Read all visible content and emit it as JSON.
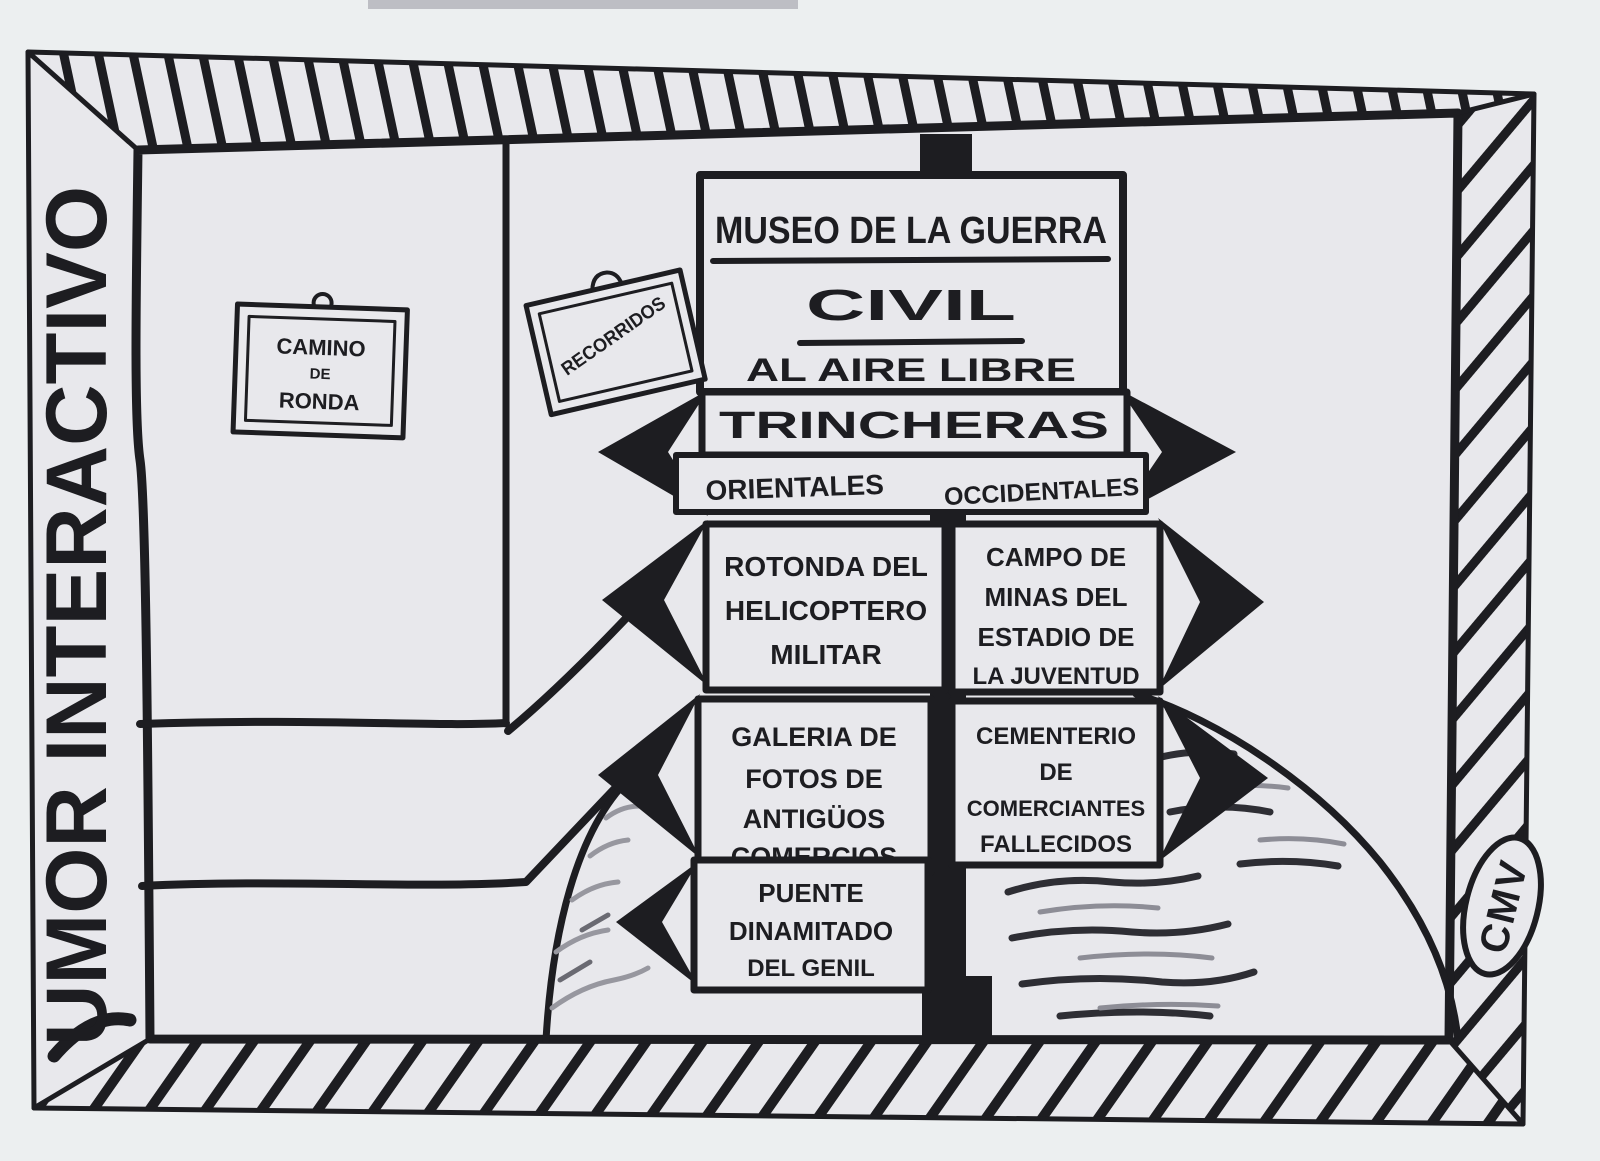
{
  "title": {
    "text": "UMOR INTERACTIVO"
  },
  "signature": {
    "text": "CMV"
  },
  "colors": {
    "paper": "#e8e8ec",
    "ink": "#1d1d21",
    "scribble_light": "#97979f",
    "scribble_dark": "#2e2e34"
  },
  "signs": {
    "camino": {
      "lines": [
        "CAMINO",
        "DE",
        "RONDA"
      ]
    },
    "recorridos": {
      "text": "RECORRIDOS"
    },
    "museo": {
      "line1": "MUSEO DE LA GUERRA",
      "line2": "CIVIL",
      "line3": "AL AIRE LIBRE"
    },
    "trincheras": {
      "label": "TRINCHERAS"
    },
    "directions": {
      "left": "ORIENTALES",
      "right": "OCCIDENTALES"
    },
    "rotonda": {
      "lines": [
        "ROTONDA DEL",
        "HELICOPTERO",
        "MILITAR"
      ]
    },
    "campo": {
      "lines": [
        "CAMPO DE",
        "MINAS DEL",
        "ESTADIO DE",
        "LA JUVENTUD"
      ]
    },
    "galeria": {
      "lines": [
        "GALERIA DE",
        "FOTOS DE",
        "ANTIGÜOS",
        "COMERCIOS"
      ]
    },
    "cementerio": {
      "lines": [
        "CEMENTERIO",
        "DE",
        "COMERCIANTES",
        "FALLECIDOS"
      ]
    },
    "puente": {
      "lines": [
        "PUENTE",
        "DINAMITADO",
        "DEL GENIL"
      ]
    }
  }
}
